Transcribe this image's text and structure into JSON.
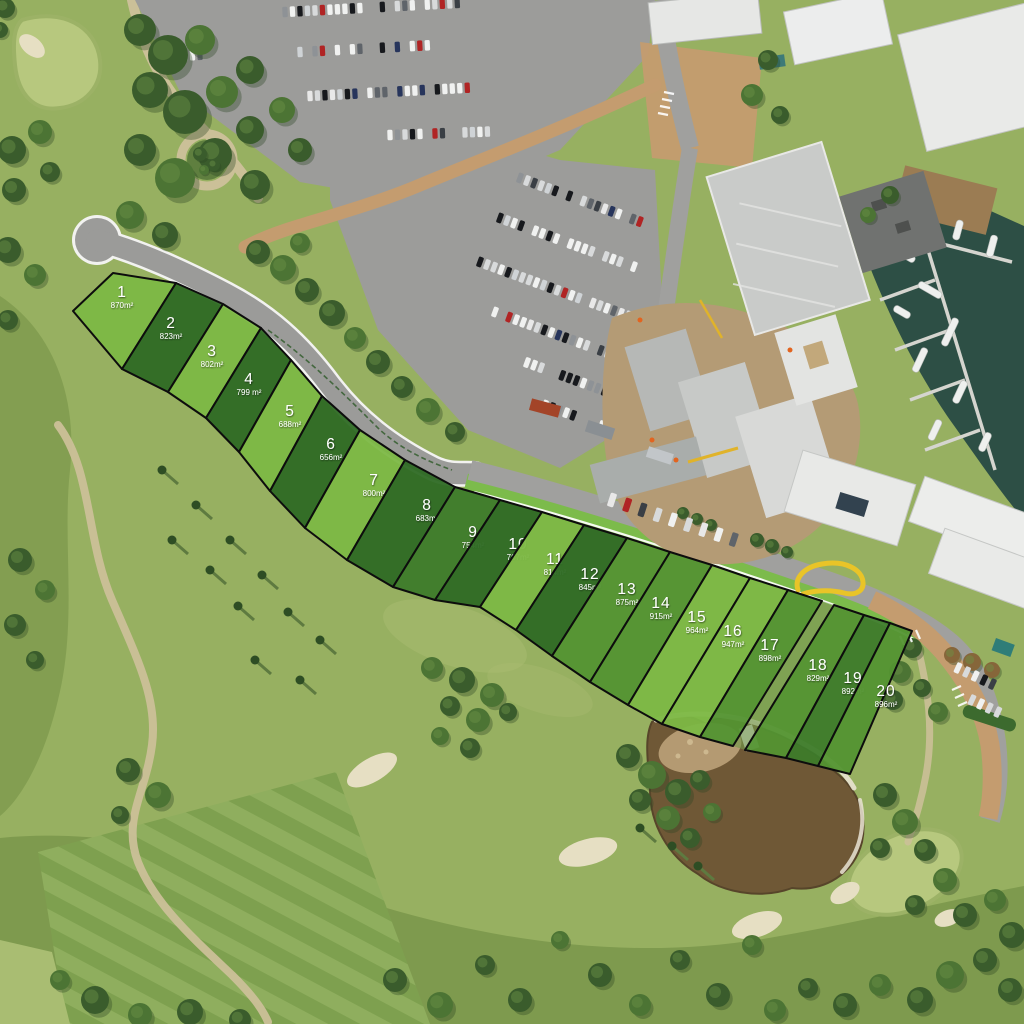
{
  "map": {
    "lots": [
      {
        "number": "1",
        "area": "870m²",
        "shade": "light"
      },
      {
        "number": "2",
        "area": "823m²",
        "shade": "dark"
      },
      {
        "number": "3",
        "area": "802m²",
        "shade": "light"
      },
      {
        "number": "4",
        "area": "799 m²",
        "shade": "dark"
      },
      {
        "number": "5",
        "area": "688m²",
        "shade": "light"
      },
      {
        "number": "6",
        "area": "656m²",
        "shade": "dark"
      },
      {
        "number": "7",
        "area": "800m²",
        "shade": "light"
      },
      {
        "number": "8",
        "area": "683m²",
        "shade": "dark"
      },
      {
        "number": "9",
        "area": "754m²",
        "shade": "mediumDark"
      },
      {
        "number": "10",
        "area": "767m²",
        "shade": "dark"
      },
      {
        "number": "11",
        "area": "814m²",
        "shade": "light"
      },
      {
        "number": "12",
        "area": "845m²",
        "shade": "dark"
      },
      {
        "number": "13",
        "area": "875m²",
        "shade": "medium"
      },
      {
        "number": "14",
        "area": "915m²",
        "shade": "medium"
      },
      {
        "number": "15",
        "area": "964m²",
        "shade": "light"
      },
      {
        "number": "16",
        "area": "947m²",
        "shade": "light"
      },
      {
        "number": "17",
        "area": "898m²",
        "shade": "medium"
      },
      {
        "number": "18",
        "area": "829m²",
        "shade": "medium"
      },
      {
        "number": "19",
        "area": "892m²",
        "shade": "mediumDark"
      },
      {
        "number": "20",
        "area": "896m²",
        "shade": "medium"
      }
    ],
    "lot_colors": {
      "light": "#7cb845",
      "lightMedium": "#6cac3e",
      "medium": "#539331",
      "mediumDark": "#3d7b2a",
      "dark": "#2e6a24",
      "border": "#0d0d0d",
      "label": "#ffffff"
    },
    "scene": {
      "fairway": "#97b061",
      "rough": "#7e9a4e",
      "range_stripe_a": "#8fae5e",
      "range_stripe_b": "#7ea04f",
      "green": "#b7c87e",
      "sand": "#e6dfc3",
      "path": "#cbc098",
      "road": "#9b9b99",
      "road_edge": "#ffffff",
      "street": "#a0a09e",
      "paver": "#c49c6f",
      "parking": "#9c9c9a",
      "verge": "#7cbb4b",
      "water": "#2d4f45",
      "pond": "#6f5836",
      "pond_dirt": "#b49a72",
      "construction_dirt": "#b49b75",
      "deck_wood": "#9b7c53",
      "accent_yellow": "#e9c428"
    }
  }
}
